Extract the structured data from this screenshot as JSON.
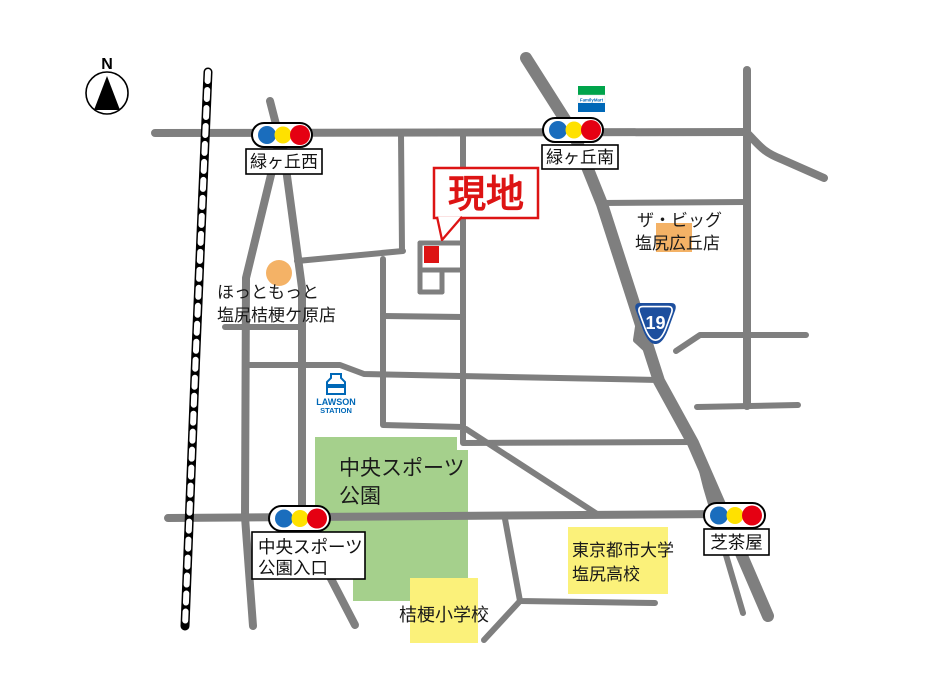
{
  "map": {
    "compass": {
      "label": "N"
    },
    "site": {
      "label": "現地"
    },
    "route_shield": {
      "number": "19"
    },
    "stores": {
      "familymart": {
        "name": "FamilyMart"
      },
      "the_big": {
        "line1": "ザ・ビッグ",
        "line2": "塩尻広丘店"
      },
      "hotto_motto": {
        "line1": "ほっともっと",
        "line2": "塩尻桔梗ケ原店"
      },
      "lawson": {
        "line1": "LAWSON",
        "line2": "STATION"
      }
    },
    "places": {
      "sports_park": {
        "line1": "中央スポーツ",
        "line2": "公園"
      },
      "tokyo_city_university_hs": {
        "line1": "東京都市大学",
        "line2": "塩尻高校"
      },
      "kikyo_elementary": {
        "name": "桔梗小学校"
      }
    },
    "intersections": {
      "midorigaoka_nishi": {
        "name": "緑ヶ丘西"
      },
      "midorigaoka_minami": {
        "name": "緑ヶ丘南"
      },
      "sports_park_entrance": {
        "line1": "中央スポーツ",
        "line2": "公園入口"
      },
      "shibachaya": {
        "name": "芝茶屋"
      }
    },
    "colors": {
      "road_gray": "#7f7f7f",
      "park_green": "#a5d08c",
      "school_yellow": "#fbf17a",
      "highlight_orange": "#f4b266",
      "site_red": "#dd1414",
      "signal_blue": "#1a6dbd",
      "signal_yellow": "#ffe100",
      "signal_red": "#e50012",
      "familymart_green": "#00a44b",
      "familymart_blue": "#0068b7",
      "lawson_blue": "#0068b7",
      "route_sign_blue": "#1d4f9e"
    }
  }
}
